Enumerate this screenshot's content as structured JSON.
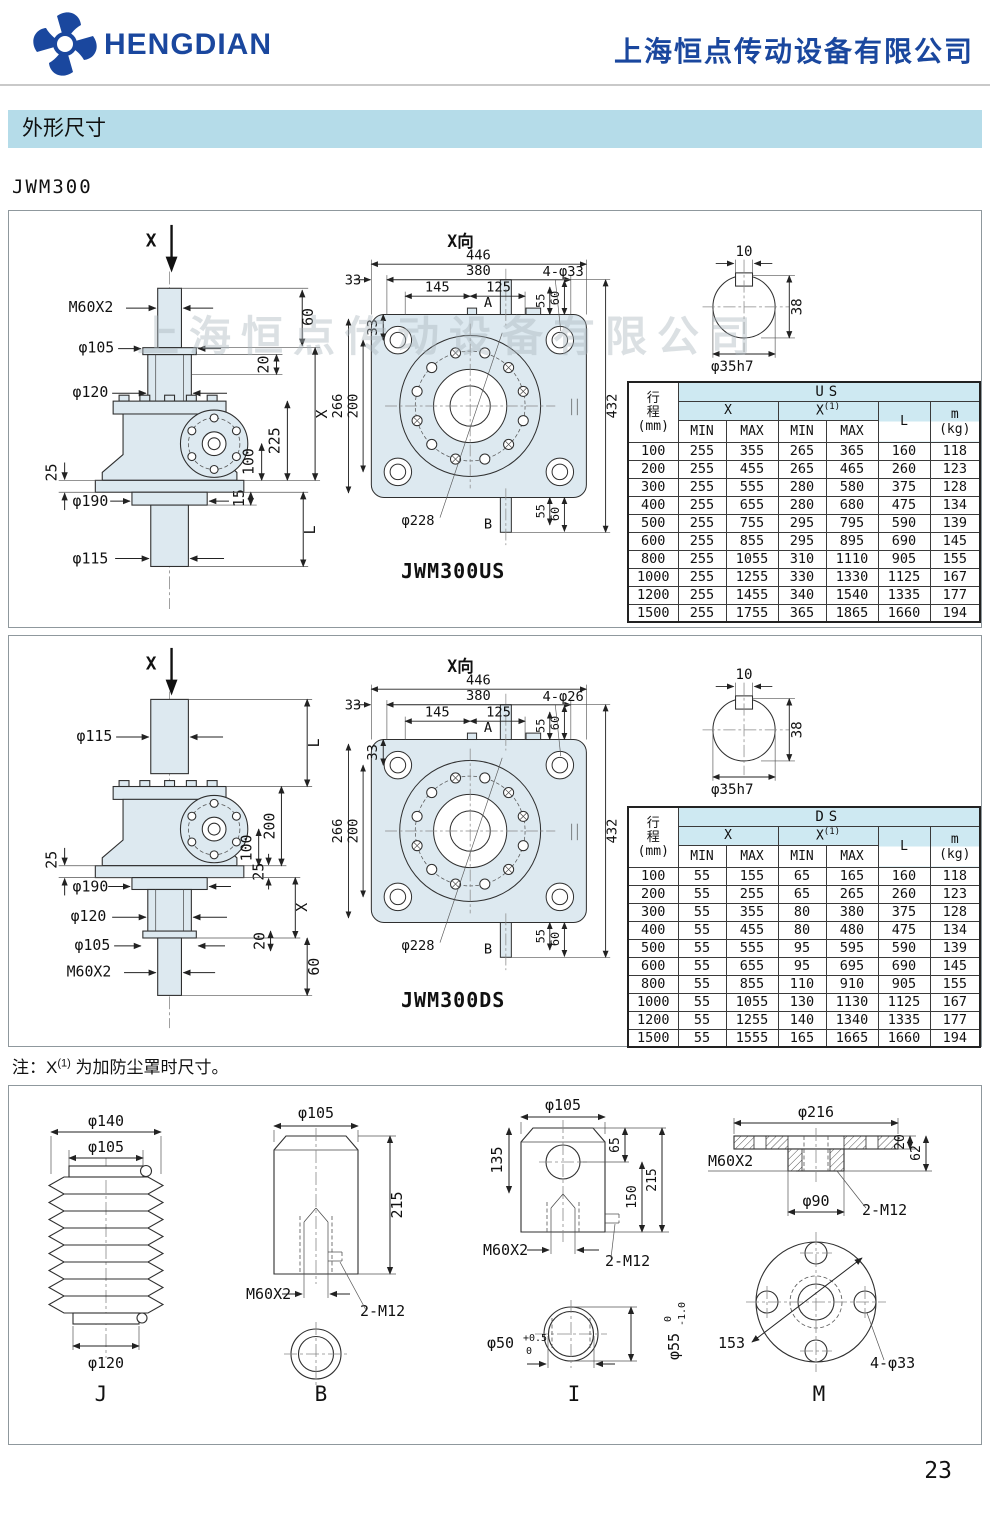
{
  "header": {
    "brand": "HENGDIAN",
    "company": "上海恒点传动设备有限公司",
    "brand_color": "#1a479e"
  },
  "section_title": "外形尺寸",
  "model_label": "JWM300",
  "watermark": "上海恒点传动设备有限公司",
  "note": {
    "p1": "注：X",
    "sup": "(1)",
    "p2": "为加防尘罩时尺寸。"
  },
  "page_number": "23",
  "shaft": {
    "k10": "10",
    "k38": "38",
    "dia": "φ35h7"
  },
  "us": {
    "caption": "JWM300US",
    "side": {
      "axis": "X",
      "thread": "M60X2",
      "d105": "φ105",
      "d120": "φ120",
      "v60": "60",
      "v20": "20",
      "vX": "X",
      "v225": "225",
      "v100": "100",
      "v25": "25",
      "d190": "φ190",
      "v15": "15",
      "d115": "φ115",
      "vL": "L"
    },
    "front": {
      "title": "X向",
      "w446": "446",
      "w380": "380",
      "w145": "145",
      "w125": "125",
      "w33t": "33",
      "w33l": "33",
      "h266": "266",
      "h200": "200",
      "h432": "432",
      "t55": "55",
      "t60": "60",
      "b55": "55",
      "b60": "60",
      "holes": "4-φ33",
      "bc": "φ228",
      "a": "A",
      "b": "B"
    },
    "table": {
      "c1a": "行",
      "c1b": "程",
      "c1u": "(mm)",
      "group": "US",
      "x": "X",
      "x1": "X",
      "x1sup": "(1)",
      "min": "MIN",
      "max": "MAX",
      "l": "L",
      "m": "m",
      "mu": "(kg)",
      "rows": [
        [
          "100",
          "255",
          "355",
          "265",
          "365",
          "160",
          "118"
        ],
        [
          "200",
          "255",
          "455",
          "265",
          "465",
          "260",
          "123"
        ],
        [
          "300",
          "255",
          "555",
          "280",
          "580",
          "375",
          "128"
        ],
        [
          "400",
          "255",
          "655",
          "280",
          "680",
          "475",
          "134"
        ],
        [
          "500",
          "255",
          "755",
          "295",
          "795",
          "590",
          "139"
        ],
        [
          "600",
          "255",
          "855",
          "295",
          "895",
          "690",
          "145"
        ],
        [
          "800",
          "255",
          "1055",
          "310",
          "1110",
          "905",
          "155"
        ],
        [
          "1000",
          "255",
          "1255",
          "330",
          "1330",
          "1125",
          "167"
        ],
        [
          "1200",
          "255",
          "1455",
          "340",
          "1540",
          "1335",
          "177"
        ],
        [
          "1500",
          "255",
          "1755",
          "365",
          "1865",
          "1660",
          "194"
        ]
      ]
    }
  },
  "ds": {
    "caption": "JWM300DS",
    "side": {
      "axis": "X",
      "d115": "φ115",
      "vL": "L",
      "v200": "200",
      "v100": "100",
      "v25l": "25",
      "v25r": "25",
      "vX": "X",
      "v20": "20",
      "v60": "60",
      "d190": "φ190",
      "d120": "φ120",
      "d105": "φ105",
      "thread": "M60X2"
    },
    "front": {
      "title": "X向",
      "w446": "446",
      "w380": "380",
      "w145": "145",
      "w125": "125",
      "w33t": "33",
      "w33l": "33",
      "h266": "266",
      "h200": "200",
      "h432": "432",
      "t55": "55",
      "t60": "60",
      "b55": "55",
      "b60": "60",
      "holes": "4-φ26",
      "bc": "φ228",
      "a": "A",
      "b": "B"
    },
    "table": {
      "c1a": "行",
      "c1b": "程",
      "c1u": "(mm)",
      "group": "DS",
      "x": "X",
      "x1": "X",
      "x1sup": "(1)",
      "min": "MIN",
      "max": "MAX",
      "l": "L",
      "m": "m",
      "mu": "(kg)",
      "rows": [
        [
          "100",
          "55",
          "155",
          "65",
          "165",
          "160",
          "118"
        ],
        [
          "200",
          "55",
          "255",
          "65",
          "265",
          "260",
          "123"
        ],
        [
          "300",
          "55",
          "355",
          "80",
          "380",
          "375",
          "128"
        ],
        [
          "400",
          "55",
          "455",
          "80",
          "480",
          "475",
          "134"
        ],
        [
          "500",
          "55",
          "555",
          "95",
          "595",
          "590",
          "139"
        ],
        [
          "600",
          "55",
          "655",
          "95",
          "695",
          "690",
          "145"
        ],
        [
          "800",
          "55",
          "855",
          "110",
          "910",
          "905",
          "155"
        ],
        [
          "1000",
          "55",
          "1055",
          "130",
          "1130",
          "1125",
          "167"
        ],
        [
          "1200",
          "55",
          "1255",
          "140",
          "1340",
          "1335",
          "177"
        ],
        [
          "1500",
          "55",
          "1555",
          "165",
          "1665",
          "1660",
          "194"
        ]
      ]
    }
  },
  "acc": {
    "j": {
      "label": "J",
      "d140": "φ140",
      "d105": "φ105",
      "d120": "φ120"
    },
    "b": {
      "label": "B",
      "d105": "φ105",
      "v215": "215",
      "thread": "M60X2",
      "holes": "2-M12"
    },
    "i": {
      "label": "I",
      "d105": "φ105",
      "v135": "135",
      "v65": "65",
      "v150": "150",
      "v215": "215",
      "thread": "M60X2",
      "holes": "2-M12",
      "d50": "φ50",
      "d50t": "+0.5",
      "d50b": "0",
      "d55": "φ55",
      "d55t": "0",
      "d55b": "-1.0"
    },
    "m": {
      "label": "M",
      "d216": "φ216",
      "v20": "20",
      "v62": "62",
      "thread": "M60X2",
      "d90": "φ90",
      "holes2": "2-M12",
      "v153": "153",
      "holes4": "4-φ33"
    }
  }
}
